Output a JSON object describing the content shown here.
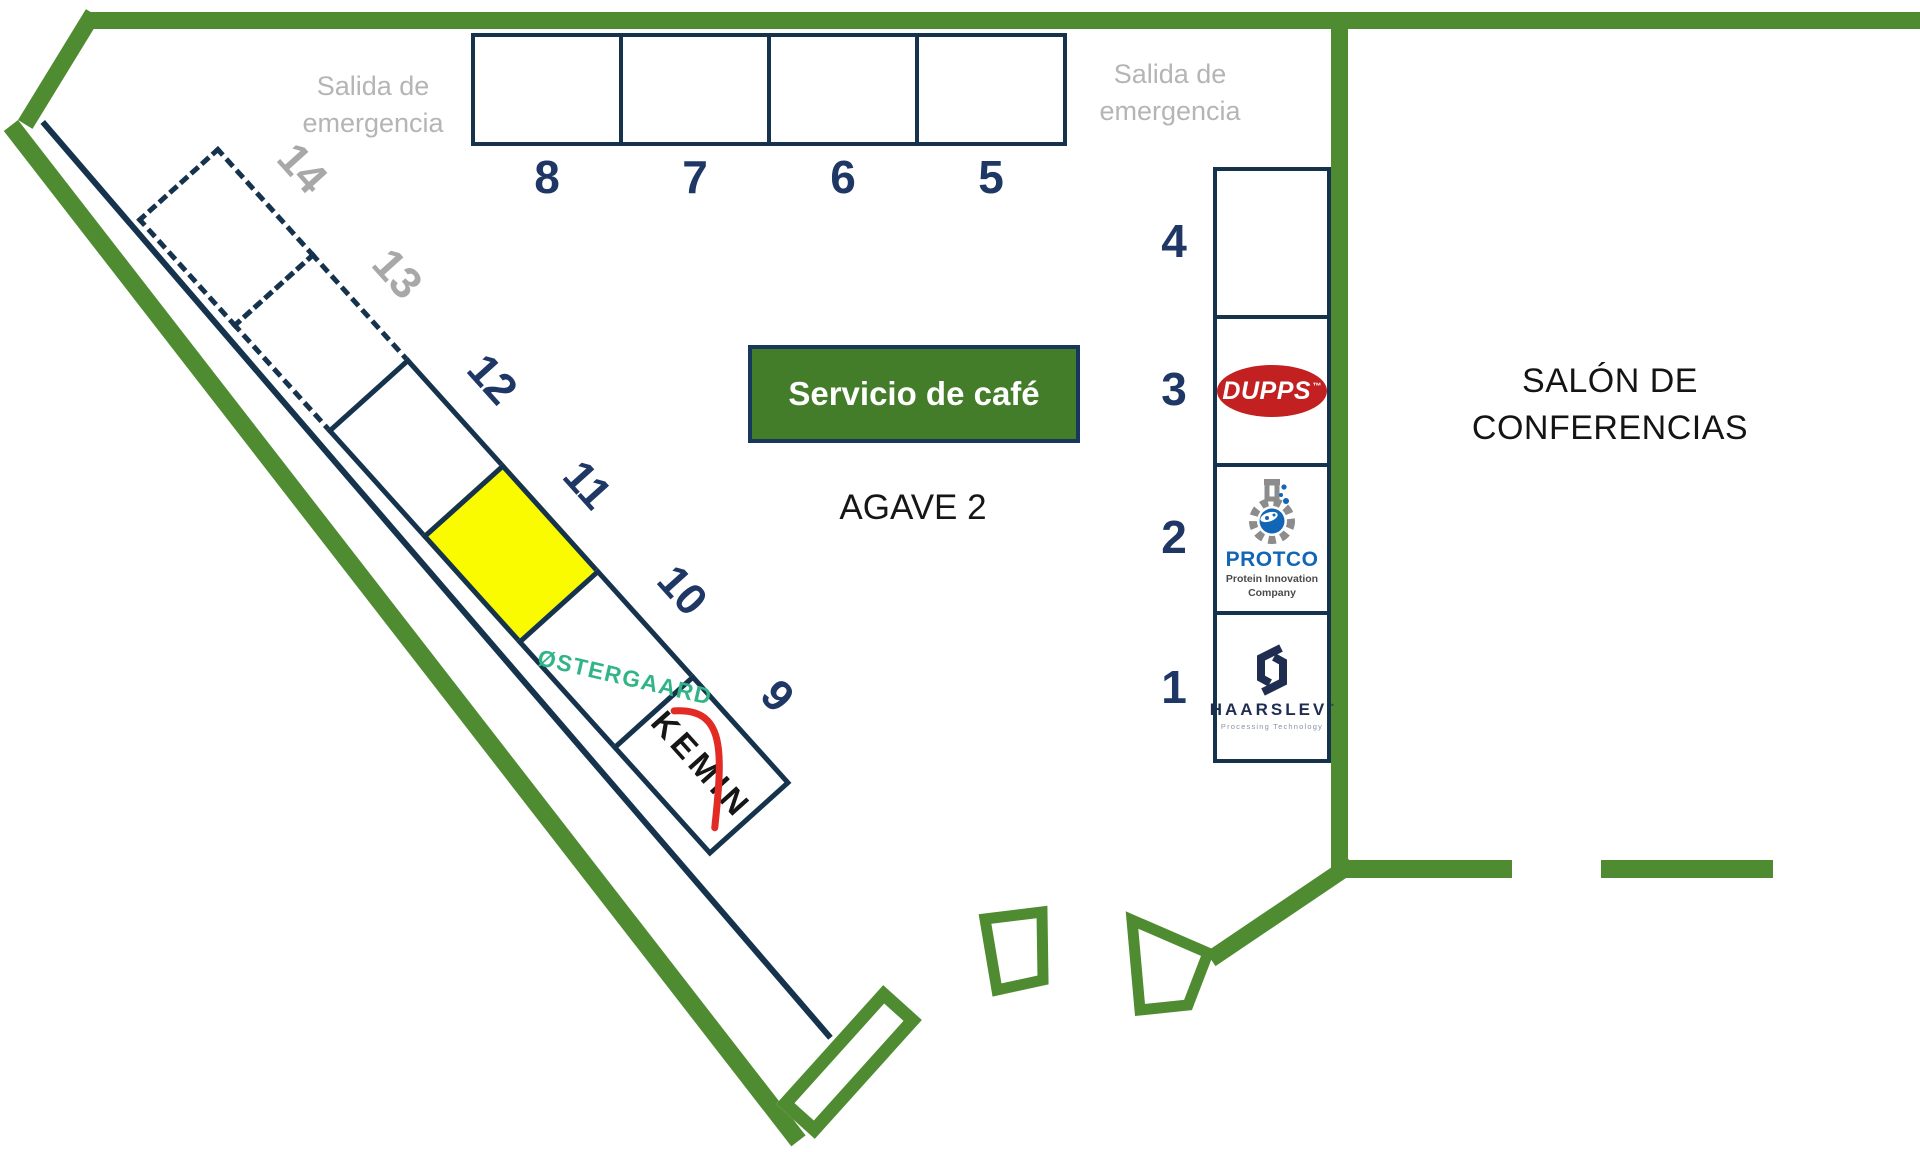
{
  "colors": {
    "wall_green": "#4f8c31",
    "booth_outline": "#16334e",
    "number_navy": "#1f3765",
    "number_gray": "#a8a8a8",
    "exit_gray": "#b5b5b5",
    "highlight_yellow": "#fbfb00",
    "coffee_green": "#447d2a",
    "dupps_red": "#c32121",
    "protco_blue": "#1266b5",
    "haarslev_navy": "#1e2d50",
    "oestergaard_green": "#31b587",
    "kemin_red": "#e22b25"
  },
  "texts": {
    "exit_left_line1": "Salida de",
    "exit_left_line2": "emergencia",
    "exit_right_line1": "Salida de",
    "exit_right_line2": "emergencia",
    "coffee_service": "Servicio de café",
    "hall_name": "AGAVE 2",
    "conference_line1": "SALÓN DE",
    "conference_line2": "CONFERENCIAS"
  },
  "top_booths": {
    "numbers": [
      "8",
      "7",
      "6",
      "5"
    ]
  },
  "right_booths": {
    "numbers": [
      "4",
      "3",
      "2",
      "1"
    ]
  },
  "diagonal_booths": {
    "numbers": [
      "14",
      "13",
      "12",
      "11",
      "10",
      "9"
    ],
    "dashed": [
      "14",
      "13"
    ],
    "highlighted": "11"
  },
  "logos": {
    "dupps": {
      "name": "DUPPS",
      "tm": "™"
    },
    "protco": {
      "name": "PROTCO",
      "tagline_line1": "Protein Innovation",
      "tagline_line2": "Company"
    },
    "haarslev": {
      "name": "HAARSLEV",
      "tm": "™",
      "tagline": "Processing Technology"
    },
    "kemin": {
      "name": "KEMIN"
    },
    "oestergaard": {
      "name": "ØSTERGAARD"
    }
  }
}
